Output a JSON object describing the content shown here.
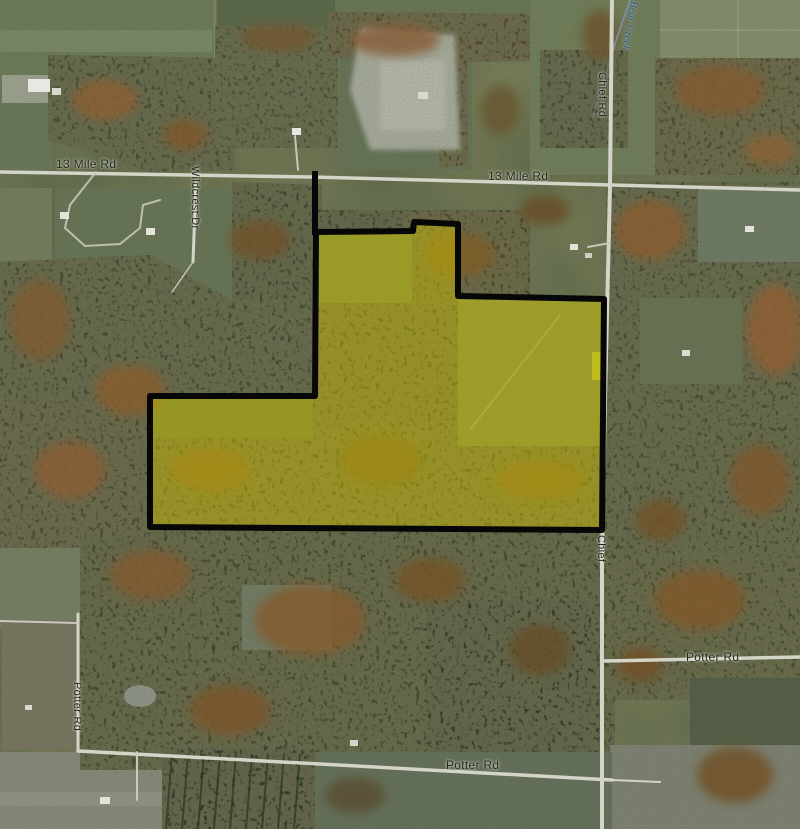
{
  "window": {
    "width": 800,
    "height": 829,
    "kind": "aerial-parcel-map"
  },
  "map": {
    "labels": {
      "mile13_left": "13 Mile Rd",
      "mile13_center": "13 Mile Rd",
      "wildcrest": "Wildcrest Dr",
      "chief_rd": "Chief Rd",
      "chief": "Chief",
      "potter_left": "Potter Rd",
      "potter_right": "Potter Rd",
      "potter_bottom": "Potter Rd",
      "bear_creek": "Bear Creek"
    },
    "parcel": {
      "points": "316,232 413,231 414,222 458,224 458,296 604,299 602,530 150,527 150,396 315,396",
      "spur_path": "M315,232 L315,174",
      "outline_color": "#070707",
      "outline_width": "6",
      "highlight_color": "#d2c300",
      "highlight_opacity": "0.45"
    },
    "colors": {
      "field_green": "#72805c",
      "forest_dark": "#44503a",
      "autumn_orange": "#9a6030",
      "road": "#d4d5c8",
      "creek_blue": "#7e95a4",
      "label_text": "#26261f",
      "creek_label_blue": "#2e5d8e"
    }
  }
}
